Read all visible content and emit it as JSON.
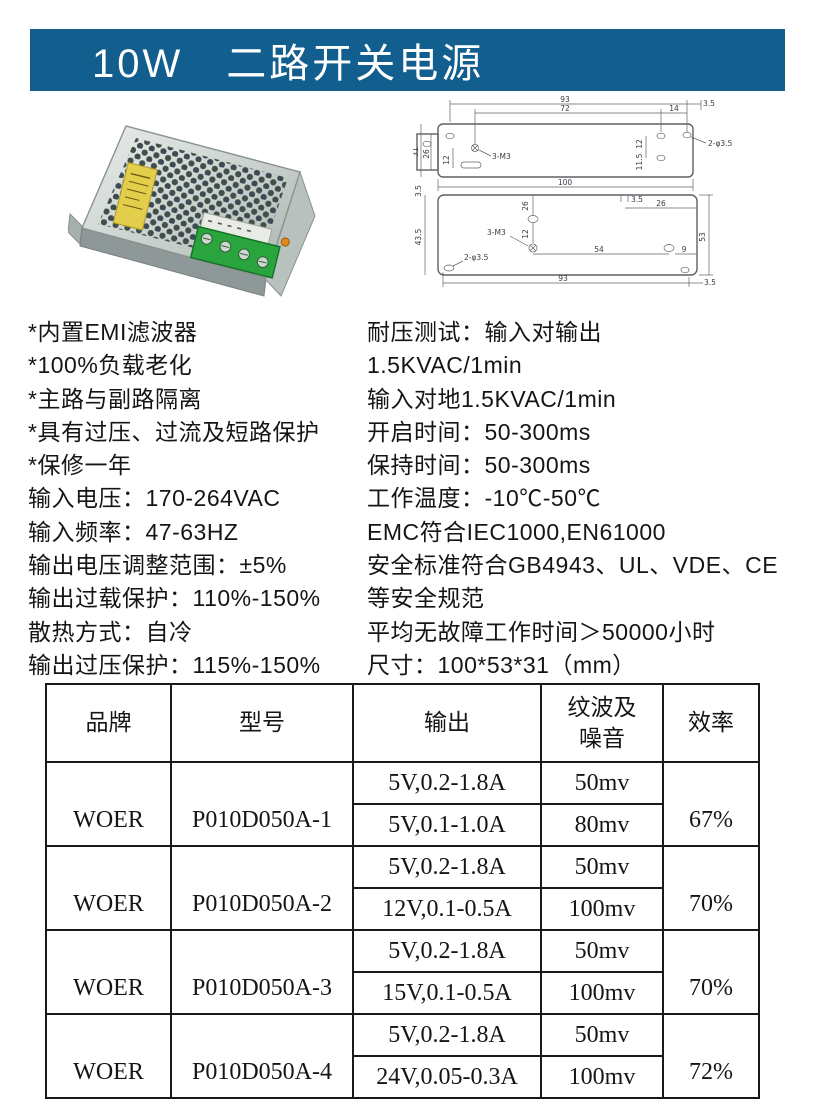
{
  "header": {
    "title": "10W　二路开关电源",
    "bg_color": "#125e8e"
  },
  "specs": {
    "left": [
      "*内置EMI滤波器",
      "*100%负载老化",
      "*主路与副路隔离",
      "*具有过压、过流及短路保护",
      "*保修一年",
      "输入电压：170-264VAC",
      "输入频率：47-63HZ",
      "输出电压调整范围：±5%",
      "输出过载保护：110%-150%",
      "散热方式：自冷",
      "输出过压保护：115%-150%"
    ],
    "right": [
      "耐压测试：输入对输出",
      "1.5KVAC/1min",
      "输入对地1.5KVAC/1min",
      "开启时间：50-300ms",
      "保持时间：50-300ms",
      "工作温度：-10℃-50℃",
      "EMC符合IEC1000,EN61000",
      "安全标准符合GB4943、UL、VDE、CE",
      "等安全规范",
      "平均无故障工作时间＞50000小时",
      "尺寸：100*53*31（mm）"
    ]
  },
  "drawing": {
    "top": {
      "d93": "93",
      "d72": "72",
      "d14": "14",
      "d35": "3.5",
      "holes": "2-φ3.5",
      "screw": "3-M3",
      "d31": "31",
      "d26": "26",
      "d12slot": "12",
      "d12r": "12",
      "d115": "11.5",
      "d100": "100"
    },
    "side": {
      "gap35": "3.5",
      "d435": "43.5",
      "d26v": "26",
      "d12": "12",
      "screw": "3-M3",
      "holes": "2-φ3.5",
      "notch35": "3.5",
      "d26h": "26",
      "d54": "54",
      "d9": "9",
      "d93": "93",
      "d53": "53",
      "d35br": "3.5"
    }
  },
  "table": {
    "headers": {
      "brand": "品牌",
      "model": "型号",
      "output": "输出",
      "ripple": "纹波及\n噪音",
      "efficiency": "效率"
    },
    "groups": [
      {
        "brand": "WOER",
        "model": "P010D050A-1",
        "efficiency": "67%",
        "rows": [
          {
            "output": "5V,0.2-1.8A",
            "ripple": "50mv"
          },
          {
            "output": "5V,0.1-1.0A",
            "ripple": "80mv"
          }
        ]
      },
      {
        "brand": "WOER",
        "model": "P010D050A-2",
        "efficiency": "70%",
        "rows": [
          {
            "output": "5V,0.2-1.8A",
            "ripple": "50mv"
          },
          {
            "output": "12V,0.1-0.5A",
            "ripple": "100mv"
          }
        ]
      },
      {
        "brand": "WOER",
        "model": "P010D050A-3",
        "efficiency": "70%",
        "rows": [
          {
            "output": "5V,0.2-1.8A",
            "ripple": "50mv"
          },
          {
            "output": "15V,0.1-0.5A",
            "ripple": "100mv"
          }
        ]
      },
      {
        "brand": "WOER",
        "model": "P010D050A-4",
        "efficiency": "72%",
        "rows": [
          {
            "output": "5V,0.2-1.8A",
            "ripple": "50mv"
          },
          {
            "output": "24V,0.05-0.3A",
            "ripple": "100mv"
          }
        ]
      }
    ]
  }
}
